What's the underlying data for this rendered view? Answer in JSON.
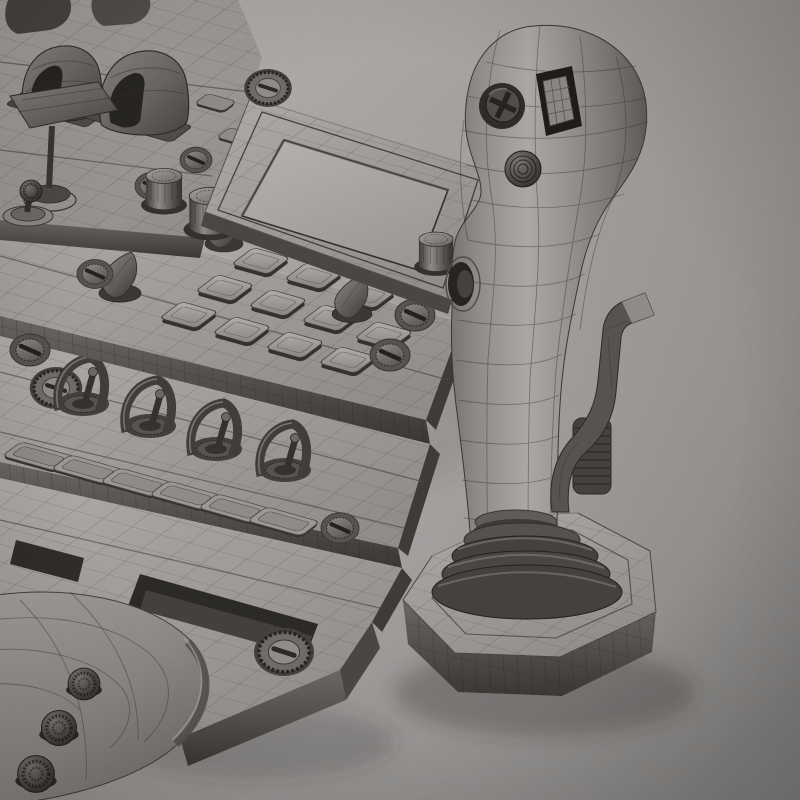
{
  "meta": {
    "description": "Grayscale 3D wireframe render of a flight joystick and cockpit control panel model",
    "render_style": "wireframe over shaded clay",
    "visible_text": "none"
  },
  "palette": {
    "bg_top_left": "#b8b5b2",
    "bg_mid": "#a3a09d",
    "bg_low": "#959290",
    "bg_bottom": "#82807e",
    "panel_top_light": "#aeaaa7",
    "panel_top_dark": "#918d8a",
    "panel_side_top": "#6b6764",
    "panel_side_bottom": "#3a3734",
    "panel_end_face": "#3f3b38",
    "screen_light": "#b5b2af",
    "screen_dark": "#9c9895",
    "widget_dark": "#45413e",
    "widget_darker": "#262421",
    "wireframe_line": "#45413e",
    "grip_light": "#aba7a4",
    "grip_dark": "#56524f",
    "shadow": "#35322f"
  },
  "scene": {
    "console": {
      "bands": [
        {
          "name": "far-band",
          "widgets": [
            {
              "name": "hooded-switch-cover",
              "count": 2
            },
            {
              "name": "paddle-lever",
              "count": 1
            },
            {
              "name": "ball-joystick",
              "count": 1
            },
            {
              "name": "small-button",
              "count": 2
            },
            {
              "name": "screw",
              "count": 2
            },
            {
              "name": "rotary-knob",
              "count": 2
            }
          ]
        },
        {
          "name": "screen-band",
          "widgets": [
            {
              "name": "display-screen",
              "count": 1
            },
            {
              "name": "knurled-screw",
              "count": 1
            },
            {
              "name": "rotary-knob",
              "count": 1
            }
          ]
        },
        {
          "name": "keypad-band",
          "widgets": [
            {
              "name": "keypad-button",
              "count": 11
            },
            {
              "name": "pointer-knob",
              "count": 3
            },
            {
              "name": "screw",
              "count": 4
            }
          ]
        },
        {
          "name": "toggle-band",
          "widgets": [
            {
              "name": "guarded-toggle-switch",
              "count": 4
            },
            {
              "name": "flat-button",
              "count": 6
            },
            {
              "name": "knurled-screw",
              "count": 1
            },
            {
              "name": "screw",
              "count": 1
            }
          ]
        },
        {
          "name": "bottom-band",
          "widgets": [
            {
              "name": "recessed-slot",
              "count": 2
            },
            {
              "name": "knurled-screw",
              "count": 1
            },
            {
              "name": "curved-housing",
              "count": 1
            },
            {
              "name": "dome-knob",
              "count": 3
            }
          ]
        }
      ]
    },
    "joystick": {
      "parts": [
        "grip-head",
        "hat-switch",
        "slider-button",
        "ribbed-button",
        "side-port",
        "grip-shaft",
        "bellows-collar",
        "ribbed-drum",
        "side-lever",
        "base-plate"
      ]
    }
  }
}
